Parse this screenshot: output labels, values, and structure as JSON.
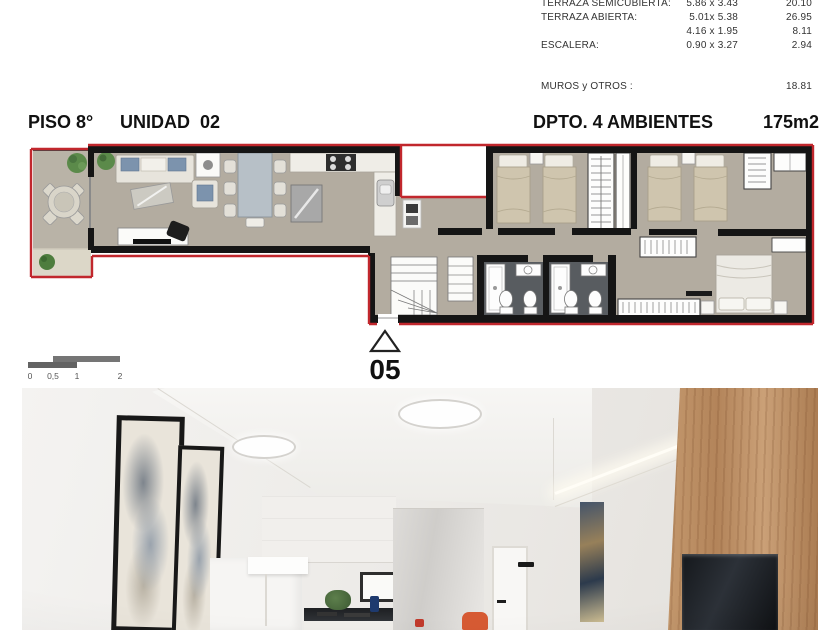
{
  "header": {
    "floor": "PISO 8°",
    "unit": "UNIDAD  02",
    "type": "DPTO. 4 AMBIENTES",
    "area": "175m2"
  },
  "measurements_table": {
    "rows": [
      {
        "label": "TERRAZA SEMICUBIERTA:",
        "dims": "5.86 x 3.43",
        "area": "20.10"
      },
      {
        "label": "TERRAZA ABIERTA:",
        "dims": "5.01x 5.38",
        "area": "26.95"
      },
      {
        "label": "",
        "dims": "4.16 x 1.95",
        "area": "8.11"
      },
      {
        "label": "ESCALERA:",
        "dims": "0.90 x 3.27",
        "area": "2.94"
      }
    ],
    "totals_row": {
      "label": "MUROS y OTROS :",
      "area": "18.81"
    }
  },
  "floor_plan": {
    "unit_marker": "05",
    "colors": {
      "outline": "#c1272d",
      "walls": "#151515",
      "floor": "#b3aca0",
      "terrace_floor": "#dcd7c8",
      "bathroom_floor": "#585c60",
      "bed_linen": "#cfc5ae"
    }
  },
  "scale_bar": {
    "labels": [
      "0",
      "0,5",
      "1",
      "2"
    ]
  },
  "photo": {
    "colors": {
      "wood_wall": "#b3845a",
      "artwork_navy": "#44546a",
      "accent_orange": "#d65a33"
    }
  }
}
